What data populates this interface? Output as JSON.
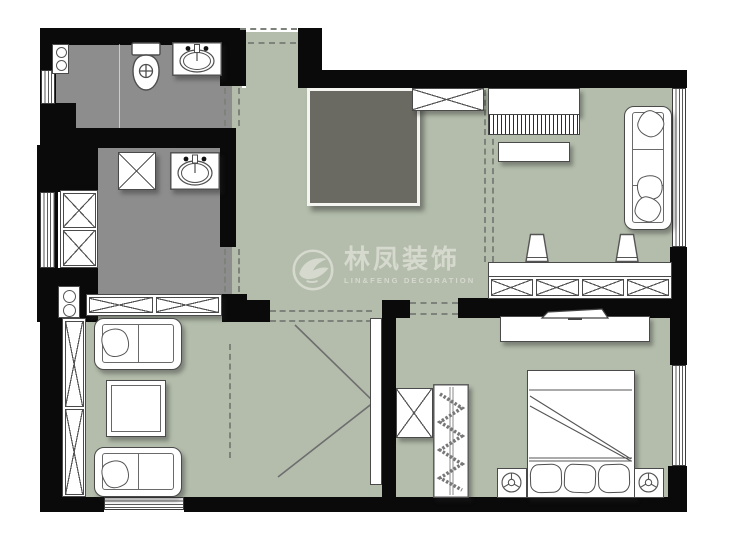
{
  "watermark": {
    "title": "林凤装饰",
    "subtitle": "LIN&FENG DECORATION",
    "logo_icon": "phoenix-circle-logo"
  },
  "palette": {
    "floor": "#b4bdac",
    "wet_floor": "#8d8d8d",
    "dark_room": "#6a6a62",
    "wall": "#0a0a0a",
    "outline": "#4a4a4a",
    "watermark": "#d7dbd0",
    "bg": "#ffffff"
  },
  "icons": {
    "toilet-icon": "top-view toilet (tank + oval bowl with cross)",
    "sink-icon": "counter with oval basin and faucet",
    "storage-x-icon": "rectangle crossed with X (cabinet/wardrobe)",
    "window-icon": "white band with parallel lines in wall",
    "door-opening-icon": "dashed gap in wall",
    "sofa-icon": "rounded sofa with seat divisions and throw pillows",
    "table-icon": "square table, double outline",
    "piano-icon": "rectangle with hatched key strip",
    "stool-icon": "trapezoid stool",
    "bar-counter-icon": "counter with four X compartments",
    "tv-icon": "thin angled flat screen on media stand",
    "bed-icon": "double bed with folded-back cover and three pillows",
    "lamp-icon": "circle lamp with three spokes on nightstand",
    "hanger-wardrobe-icon": "closet with zigzag hanger rail",
    "swing-line-icon": "chevron floor lines"
  }
}
